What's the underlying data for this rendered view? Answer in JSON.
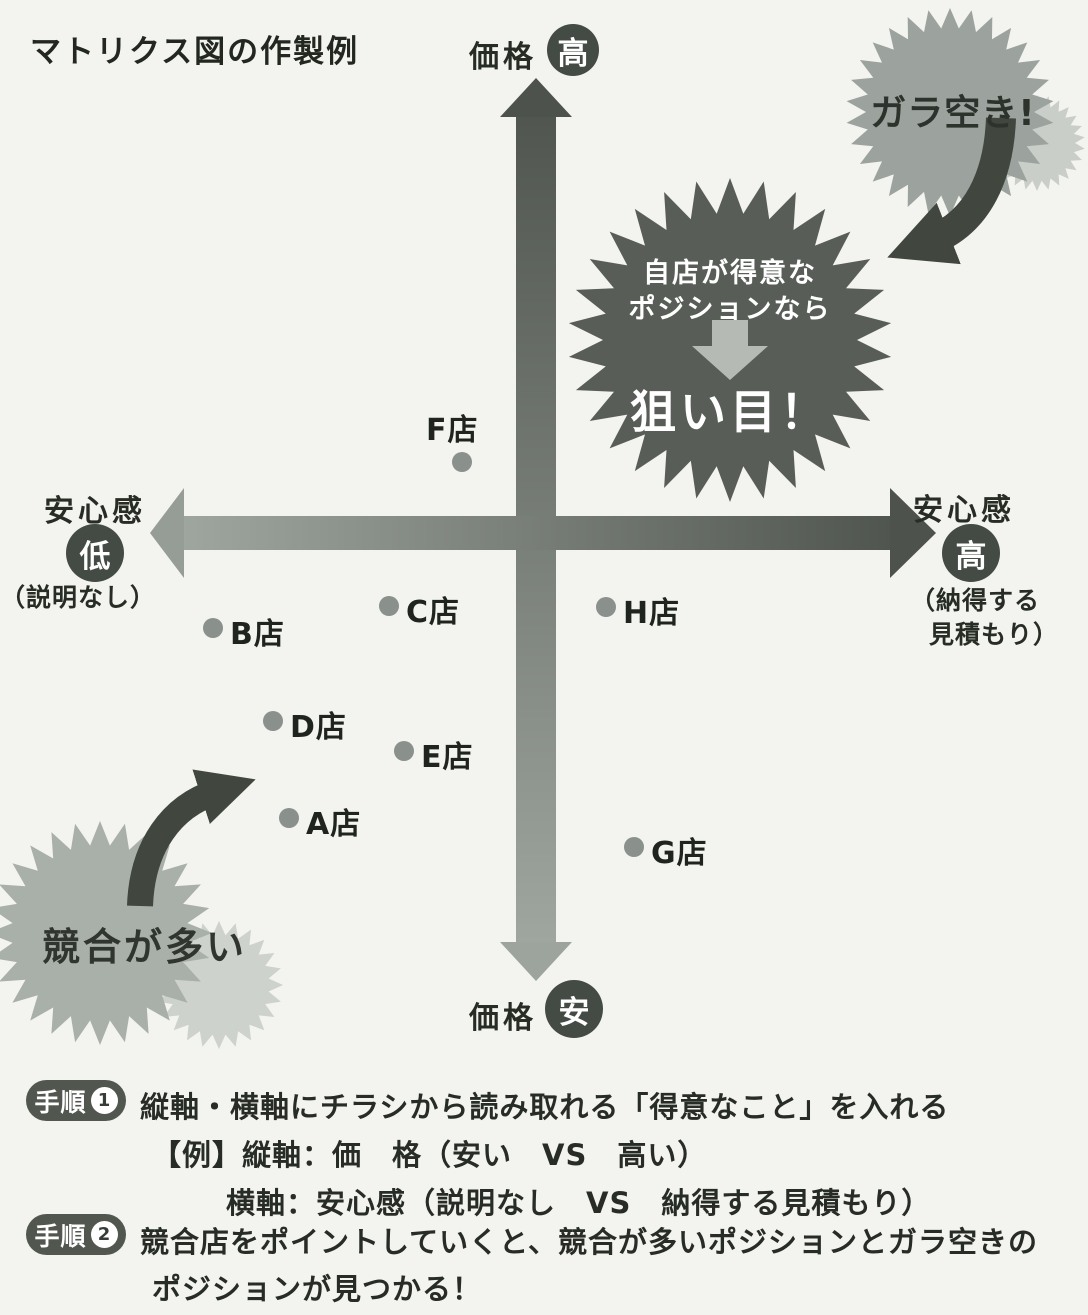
{
  "title": "マトリクス図の作製例",
  "axes": {
    "vertical": {
      "label": "価格",
      "top_badge": "高",
      "bottom_badge": "安"
    },
    "horizontal": {
      "label": "安心感",
      "left_badge": "低",
      "right_badge": "高",
      "left_note": "（説明なし）",
      "right_note_line1": "（納得する",
      "right_note_line2": "見積もり）"
    }
  },
  "callouts": {
    "open_space": "ガラ空き!",
    "center": {
      "line1": "自店が得意な",
      "line2": "ポジションなら",
      "headline": "狙い目！"
    },
    "crowded": "競合が多い"
  },
  "points": [
    {
      "name": "F店",
      "x": 462,
      "y": 462,
      "lx": 426,
      "ly": 405
    },
    {
      "name": "B店",
      "x": 213,
      "y": 628,
      "lx": 230,
      "ly": 609
    },
    {
      "name": "C店",
      "x": 389,
      "y": 606,
      "lx": 406,
      "ly": 587
    },
    {
      "name": "H店",
      "x": 606,
      "y": 607,
      "lx": 623,
      "ly": 588
    },
    {
      "name": "D店",
      "x": 273,
      "y": 721,
      "lx": 290,
      "ly": 702
    },
    {
      "name": "E店",
      "x": 404,
      "y": 751,
      "lx": 421,
      "ly": 732
    },
    {
      "name": "A店",
      "x": 289,
      "y": 818,
      "lx": 306,
      "ly": 799
    },
    {
      "name": "G店",
      "x": 634,
      "y": 847,
      "lx": 651,
      "ly": 828
    }
  ],
  "steps": [
    {
      "badge": "手順",
      "number": "1",
      "text": "縦軸・横軸にチラシから読み取れる「得意なこと」を入れる"
    },
    {
      "text": "【例】縦軸：価　格（安い　VS　高い）"
    },
    {
      "text": "横軸：安心感（説明なし　VS　納得する見積もり）"
    },
    {
      "badge": "手順",
      "number": "2",
      "text": "競合店をポイントしていくと、競合が多いポジションとガラ空きの"
    },
    {
      "text": "ポジションが見つかる！"
    }
  ],
  "colors": {
    "paper": "#f3f3f0",
    "axis_dark": "#50564f",
    "axis_light": "#9fa59f",
    "badge_circle": "#444b44",
    "starburst_gray": "#9ca29d",
    "starburst_dark": "#585e57",
    "starburst_crowded": "#a9afa9",
    "starburst_echo": "#c9cec9",
    "point_dot": "#8a908b",
    "curved_arrow": "#41473f",
    "pill": "#51574f"
  },
  "chart_data": {
    "type": "scatter",
    "title": "マトリクス図の作製例",
    "x_axis": {
      "label": "安心感",
      "low": "低（説明なし）",
      "high": "高（納得する見積もり）"
    },
    "y_axis": {
      "label": "価格",
      "low": "安",
      "high": "高"
    },
    "points": [
      {
        "name": "F店",
        "x": -0.19,
        "y": 0.15
      },
      {
        "name": "B店",
        "x": -0.83,
        "y": -0.21
      },
      {
        "name": "C店",
        "x": -0.38,
        "y": -0.16
      },
      {
        "name": "H店",
        "x": 0.18,
        "y": -0.16
      },
      {
        "name": "D店",
        "x": -0.67,
        "y": -0.41
      },
      {
        "name": "E店",
        "x": -0.34,
        "y": -0.48
      },
      {
        "name": "A店",
        "x": -0.63,
        "y": -0.62
      },
      {
        "name": "G店",
        "x": 0.25,
        "y": -0.68
      }
    ],
    "annotations": [
      {
        "text": "ガラ空き!",
        "position": "upper-right"
      },
      {
        "text": "自店が得意なポジションなら 狙い目！",
        "position": "upper-right-center"
      },
      {
        "text": "競合が多い",
        "position": "lower-left"
      }
    ],
    "legend": false,
    "grid": false
  }
}
